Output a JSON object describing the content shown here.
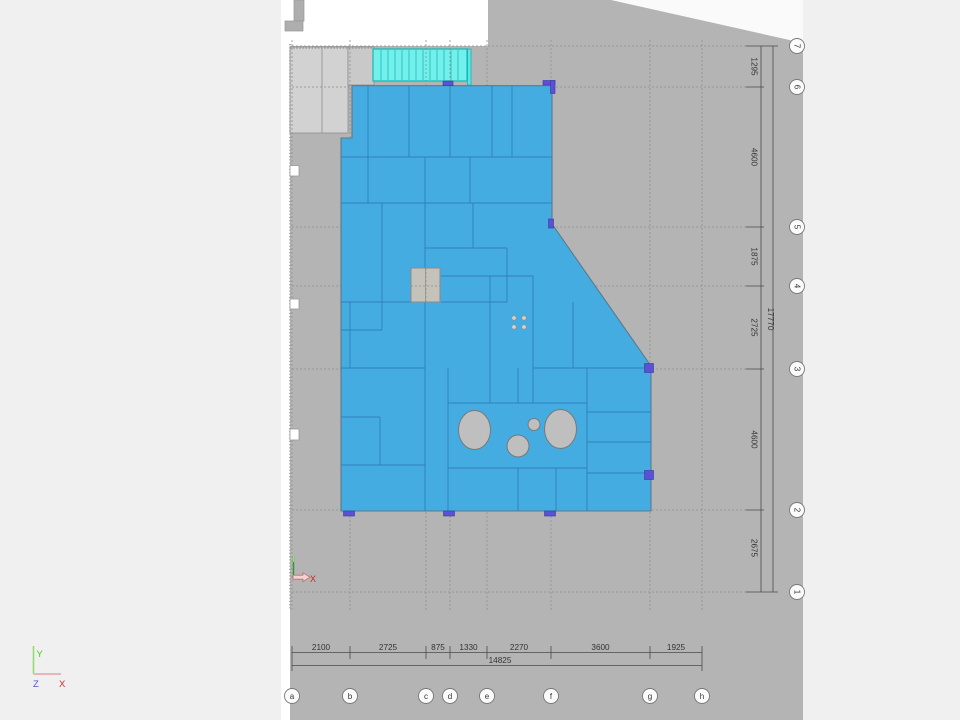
{
  "drawing": {
    "type": "floor-plan-slab-view",
    "grid": {
      "columns": [
        "a",
        "b",
        "c",
        "d",
        "e",
        "f",
        "g",
        "h"
      ],
      "rows": [
        "7",
        "6",
        "5",
        "4",
        "3",
        "2",
        "1"
      ]
    },
    "dimensions": {
      "bottom": {
        "segments": [
          "2100",
          "2725",
          "875",
          "1330",
          "2270",
          "3600",
          "1925"
        ],
        "total": "14825"
      },
      "right": {
        "segments": [
          "1295",
          "4600",
          "1875",
          "2725",
          "4600",
          "2675"
        ],
        "total": "17770"
      }
    },
    "axis_triad": {
      "y_label": "Y",
      "z_label": "Z",
      "x_label": "X"
    },
    "ucs_marker": {
      "x_label": "X"
    },
    "colors": {
      "canvas_gray": "#b4b4b4",
      "page_background": "#f0f0f0",
      "sheet_white": "#ffffff",
      "slab_blue": "#45ace2",
      "slab_outline": "#5d7a8c",
      "panel_line_blue": "#2f7fb5",
      "stair_cyan": "#73f0eb",
      "stair_teal_edge": "#16b8b4",
      "column_marker_purple": "#5a52d4",
      "adjacent_building_gray": "#d2d2d2",
      "hole_gray": "#bfbfbf",
      "ucs_green": "#3fcf1f",
      "ucs_red": "#cf2f2f",
      "ucs_blue": "#5252d0"
    }
  }
}
